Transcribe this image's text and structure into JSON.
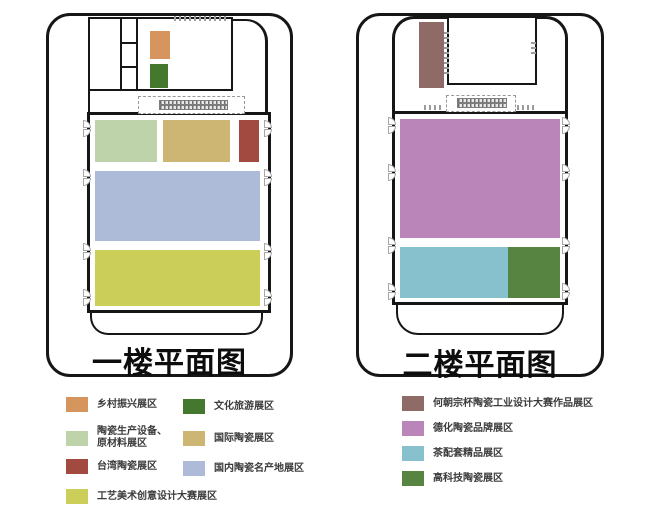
{
  "floor1": {
    "title": "一楼平面图",
    "zones": {
      "rural": {
        "label": "乡村振兴展区",
        "color": "#d6955c"
      },
      "production": {
        "label": "陶瓷生产设备、\n原材料展区",
        "color": "#bed3a9"
      },
      "taiwan": {
        "label": "台湾陶瓷展区",
        "color": "#a34a40"
      },
      "craft": {
        "label": "工艺美术创意设计大赛展区",
        "color": "#cbcf59"
      },
      "culture": {
        "label": "文化旅游展区",
        "color": "#44782f"
      },
      "international": {
        "label": "国际陶瓷展区",
        "color": "#cdb574"
      },
      "domestic": {
        "label": "国内陶瓷名产地展区",
        "color": "#aebbd8"
      }
    }
  },
  "floor2": {
    "title": "二楼平面图",
    "zones": {
      "hechaozong": {
        "label": "何朝宗杯陶瓷工业设计大赛作品展区",
        "color": "#8e6b66"
      },
      "dehua": {
        "label": "德化陶瓷品牌展区",
        "color": "#ba85b8"
      },
      "tea": {
        "label": "茶配套精品展区",
        "color": "#88c1ce"
      },
      "hightech": {
        "label": "高科技陶瓷展区",
        "color": "#578440"
      }
    }
  },
  "symbols": {
    "door": "double-swing-door-arcs",
    "escalator": "hatched-escalator-box",
    "stairs": "stair-core-cells"
  },
  "wall_color": "#161616"
}
